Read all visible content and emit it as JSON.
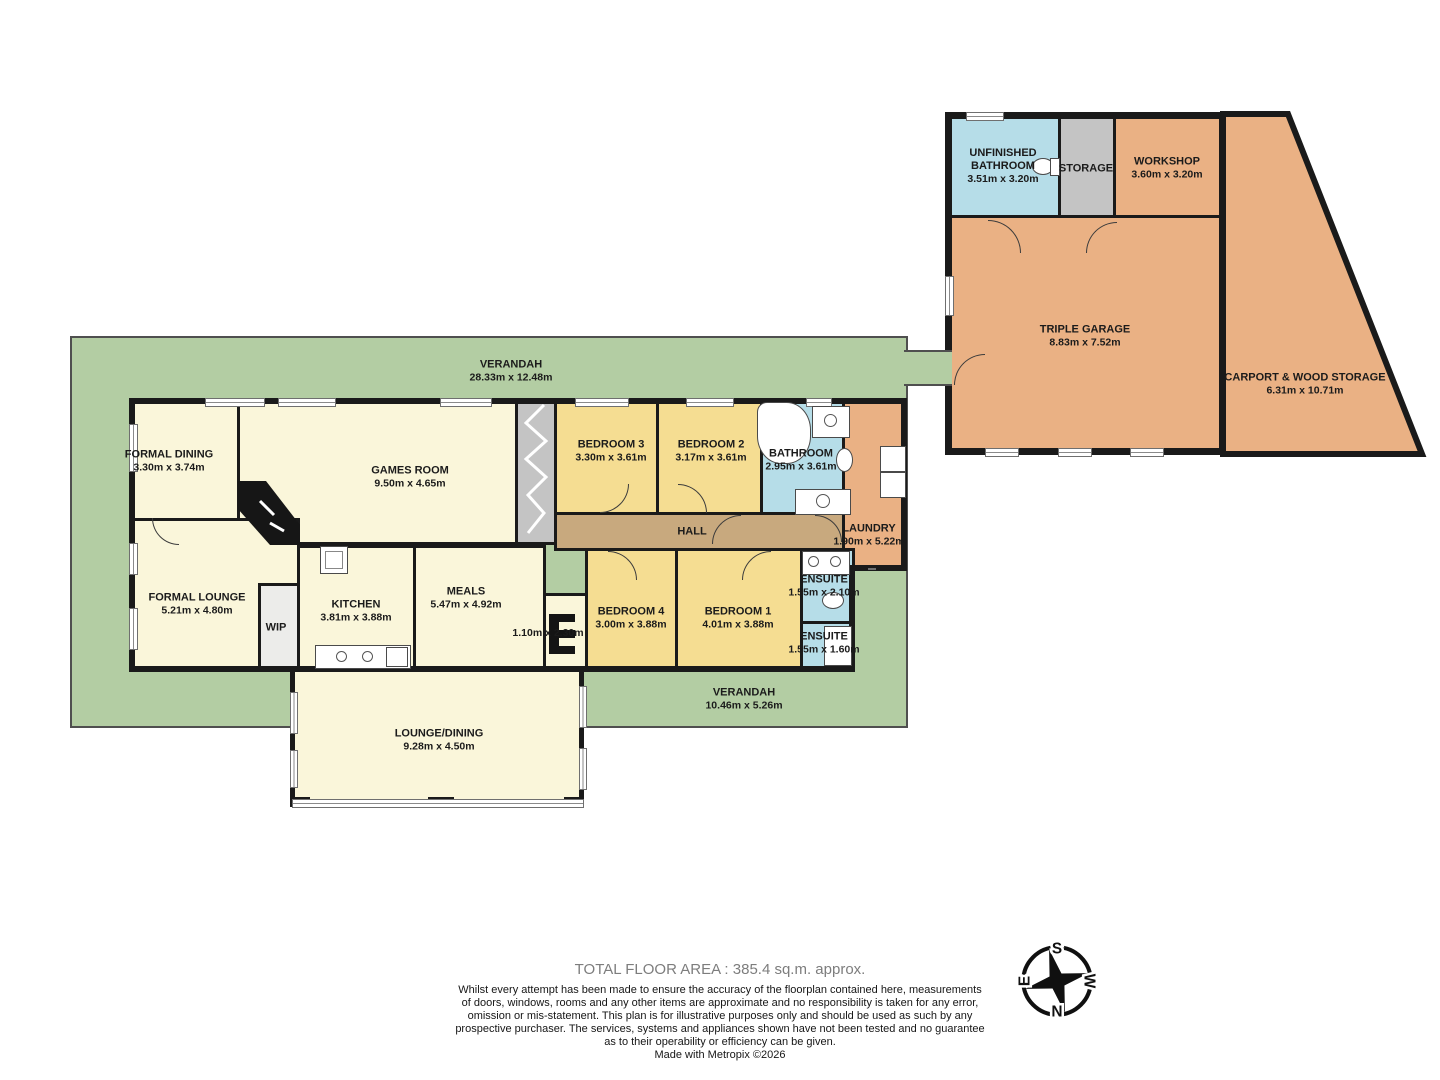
{
  "rooms": {
    "verandah_top": {
      "name": "VERANDAH",
      "dims": "28.33m x 12.48m"
    },
    "verandah_bottom": {
      "name": "VERANDAH",
      "dims": "10.46m x 5.26m"
    },
    "formal_dining": {
      "name": "FORMAL DINING",
      "dims": "3.30m x 3.74m"
    },
    "games_room": {
      "name": "GAMES ROOM",
      "dims": "9.50m x 4.65m"
    },
    "bedroom3": {
      "name": "BEDROOM 3",
      "dims": "3.30m x 3.61m"
    },
    "bedroom2": {
      "name": "BEDROOM 2",
      "dims": "3.17m x 3.61m"
    },
    "bathroom": {
      "name": "BATHROOM",
      "dims": "2.95m x 3.61m"
    },
    "laundry": {
      "name": "LAUNDRY",
      "dims": "1.90m x 5.22m"
    },
    "hall": {
      "name": "HALL"
    },
    "formal_lounge": {
      "name": "FORMAL LOUNGE",
      "dims": "5.21m x 4.80m"
    },
    "wip": {
      "name": "WIP"
    },
    "kitchen": {
      "name": "KITCHEN",
      "dims": "3.81m x 3.88m"
    },
    "meals": {
      "name": "MEALS",
      "dims": "5.47m x 4.92m"
    },
    "store": {
      "dims": "1.10m x 2.30m"
    },
    "bedroom4": {
      "name": "BEDROOM 4",
      "dims": "3.00m x 3.88m"
    },
    "bedroom1": {
      "name": "BEDROOM 1",
      "dims": "4.01m x 3.88m"
    },
    "ensuite1": {
      "name": "ENSUITE",
      "dims": "1.55m x 2.10m"
    },
    "ensuite2": {
      "name": "ENSUITE",
      "dims": "1.55m x 1.60m"
    },
    "lounge_dining": {
      "name": "LOUNGE/DINING",
      "dims": "9.28m x 4.50m"
    },
    "unfinished_bathroom": {
      "name": "UNFINISHED BATHROOM",
      "dims": "3.51m x 3.20m"
    },
    "storage": {
      "name": "STORAGE"
    },
    "workshop": {
      "name": "WORKSHOP",
      "dims": "3.60m x 3.20m"
    },
    "triple_garage": {
      "name": "TRIPLE GARAGE",
      "dims": "8.83m x 7.52m"
    },
    "carport": {
      "name": "CARPORT & WOOD STORAGE",
      "dims": "6.31m x 10.71m"
    }
  },
  "compass": {
    "top": "S",
    "right": "W",
    "bottom": "N",
    "left": "E"
  },
  "footer": {
    "total_area": "TOTAL FLOOR AREA : 385.4 sq.m. approx.",
    "disclaimer": [
      "Whilst every attempt has been made to ensure the accuracy of the floorplan contained here, measurements",
      "of doors, windows, rooms and any other items are approximate and no responsibility is taken for any error,",
      "omission or mis-statement. This plan is for illustrative purposes only and should be used as such by any",
      "prospective purchaser. The services, systems and appliances shown have not been tested and no guarantee",
      "as to their operability or efficiency can be given."
    ],
    "credit": "Made with Metropix ©2026"
  },
  "colors": {
    "verandah": "#b3cda3",
    "floor": "#faf6da",
    "bedroom": "#f5dd92",
    "wet_area": "#b6dde8",
    "garage": "#eab184",
    "storage_grey": "#c4c4c4",
    "hall": "#c8a97e",
    "wall": "#1a1a1a"
  }
}
